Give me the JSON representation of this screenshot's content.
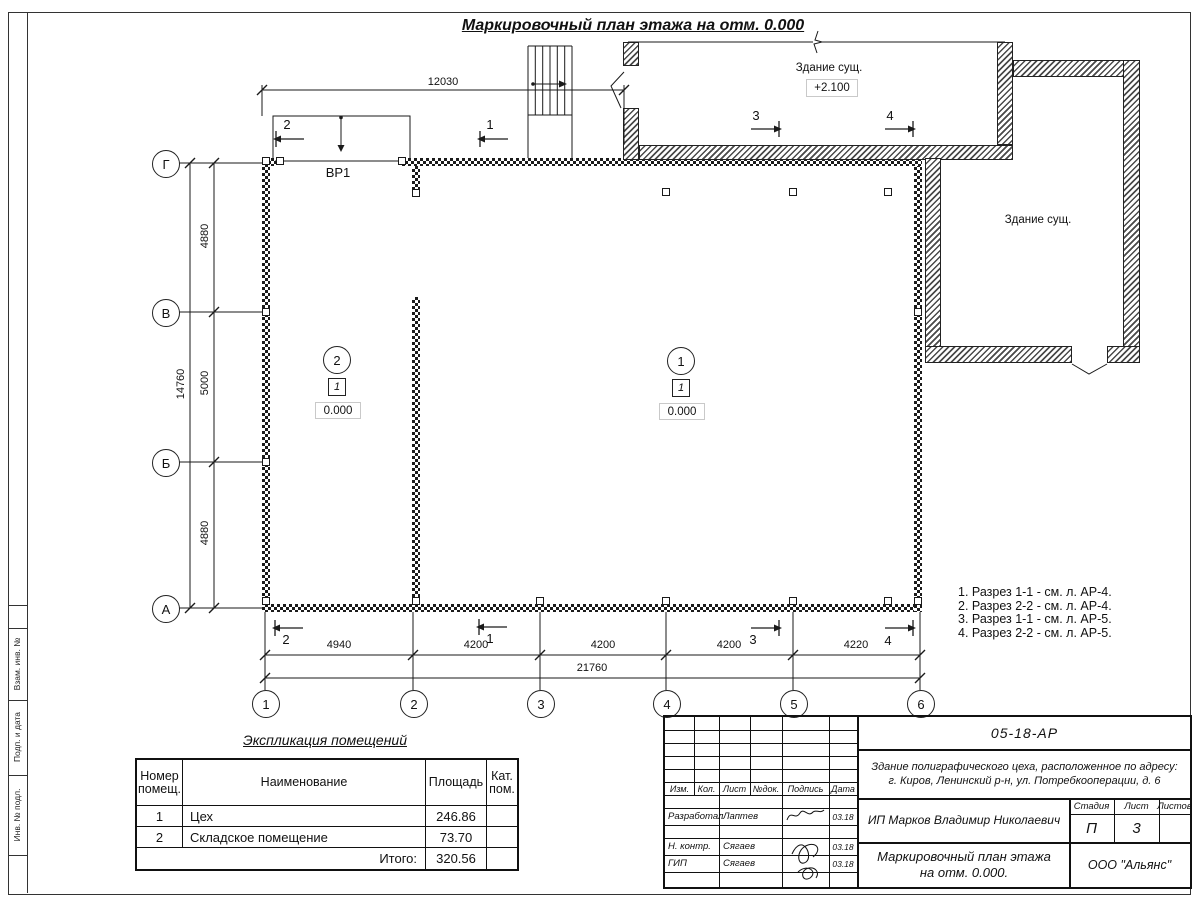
{
  "page": {
    "title": "Маркировочный план этажа на отм. 0.000"
  },
  "plan": {
    "gate_label": "ВР1",
    "existing_building_top": {
      "name": "Здание сущ.",
      "elevation": "+2.100"
    },
    "existing_building_right": {
      "name": "Здание сущ."
    },
    "room_tags": [
      {
        "room_number": "2",
        "type_mark": "1",
        "elevation": "0.000"
      },
      {
        "room_number": "1",
        "type_mark": "1",
        "elevation": "0.000"
      }
    ],
    "row_axes": [
      "Г",
      "В",
      "Б",
      "А"
    ],
    "col_axes": [
      "1",
      "2",
      "3",
      "4",
      "5",
      "6"
    ],
    "dimensions": {
      "top_width": "12030",
      "left_chain": [
        "4880",
        "5000",
        "4880"
      ],
      "left_total": "14760",
      "bottom_chain": [
        "4940",
        "4200",
        "4200",
        "4200",
        "4220"
      ],
      "bottom_total": "21760"
    },
    "sections_top": [
      "2",
      "1",
      "3",
      "4"
    ],
    "sections_bottom": [
      "2",
      "1",
      "3",
      "4"
    ]
  },
  "notes": [
    "1. Разрез 1-1 - см. л. АР-4.",
    "2. Разрез 2-2 - см. л. АР-4.",
    "3. Разрез 1-1 - см. л. АР-5.",
    "4. Разрез 2-2 - см. л. АР-5."
  ],
  "explication": {
    "title": "Экспликация помещений",
    "headers": {
      "number": "Номер\nпомещ.",
      "name": "Наименование",
      "area": "Площадь",
      "category": "Кат.\nпом."
    },
    "rows": [
      {
        "number": "1",
        "name": "Цех",
        "area": "246.86",
        "category": ""
      },
      {
        "number": "2",
        "name": "Складское помещение",
        "area": "73.70",
        "category": ""
      }
    ],
    "total_label": "Итого:",
    "total_area": "320.56"
  },
  "titleblock": {
    "doc_number": "05-18-АР",
    "project_description": "Здание полиграфического цеха, расположенное по адресу:\nг. Киров,  Ленинский р-н, ул. Потребкооперации, д. 6",
    "client": "ИП Марков Владимир Николаевич",
    "sheet_title": "Маркировочный план этажа\nна отм. 0.000.",
    "company": "ООО \"Альянс\"",
    "columns": {
      "izm": "Изм.",
      "kol": "Кол.",
      "list": "Лист",
      "doc": "№док.",
      "sign": "Подпись",
      "date": "Дата"
    },
    "stage_label": "Стадия",
    "stage": "П",
    "sheet_label": "Лист",
    "sheet": "3",
    "sheets_label": "Листов",
    "sheets": "",
    "roles": [
      {
        "role": "Разработал",
        "name": "Лаптев",
        "date": "03.18"
      },
      {
        "role": "Н. контр.",
        "name": "Сягаев",
        "date": "03.18"
      },
      {
        "role": "ГИП",
        "name": "Сягаев",
        "date": "03.18"
      }
    ]
  },
  "side_stamp": [
    "Взам. инв. №",
    "Подп. и дата",
    "Инв. № подл."
  ]
}
